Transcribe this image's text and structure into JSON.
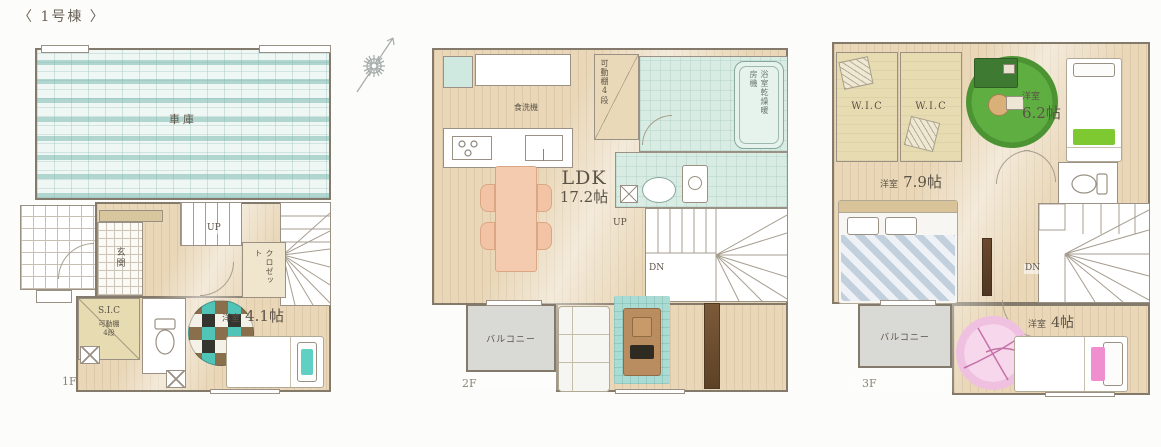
{
  "meta": {
    "title": "〈 1号棟 〉",
    "compass": "north-compass"
  },
  "f1": {
    "floor_label": "1F",
    "garage": "車庫",
    "entrance": "玄関",
    "stairs_up": "UP",
    "closet": "クロゼット",
    "sic": "S.I.C",
    "sic_shelf": "可動棚",
    "sic_shelf_levels": "4段",
    "room41_name": "洋室",
    "room41_size": "4.1帖"
  },
  "f2": {
    "floor_label": "2F",
    "dishwasher": "食洗機",
    "pantry_shelf": "可動棚4段",
    "bath_dryer": "浴室乾燥暖房機",
    "ldk_name": "LDK",
    "ldk_size": "17.2帖",
    "stairs_up": "UP",
    "stairs_down": "DN",
    "balcony": "バルコニー"
  },
  "f3": {
    "floor_label": "3F",
    "wic_left": "W.I.C",
    "wic_right": "W.I.C",
    "room62_name": "洋室",
    "room62_size": "6.2帖",
    "room79_name": "洋室",
    "room79_size": "7.9帖",
    "stairs_down": "DN",
    "balcony": "バルコニー",
    "room4_name": "洋室",
    "room4_size": "4帖"
  },
  "colors": {
    "wood_floor": "#e9d7b8",
    "garage_stripe": "#74b4ab",
    "wet_area": "#d8ece3",
    "balcony_gray": "#d9d9d6",
    "rug_teal": "#abdcd4",
    "rug_green": "#55a03c",
    "rug_pink": "#f3cae4",
    "dining_table": "#f5cbb0",
    "wall": "#847a6b"
  }
}
